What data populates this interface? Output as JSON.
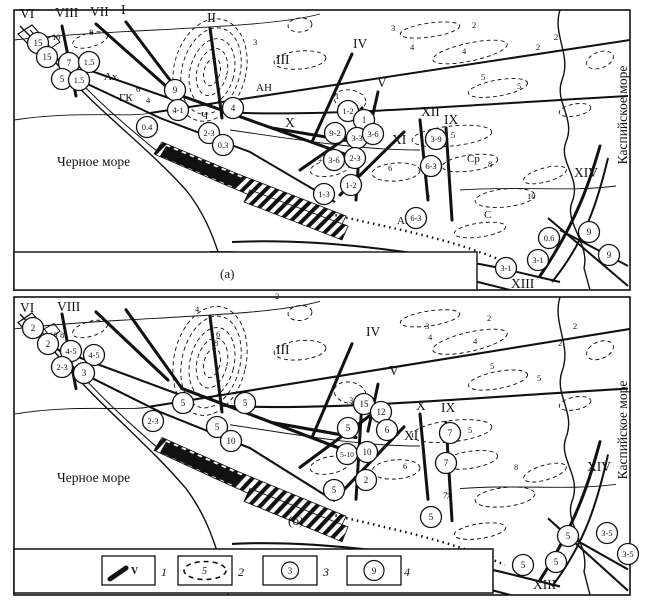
{
  "figure": {
    "panel_a_label": "(а)",
    "panel_b_label": "(б)",
    "black_sea": "Черное море",
    "caspian_sea": "Каспийское море"
  },
  "panel_a": {
    "roman": [
      {
        "t": "VI",
        "x": 20,
        "y": 18
      },
      {
        "t": "VIII",
        "x": 55,
        "y": 17
      },
      {
        "t": "VII",
        "x": 90,
        "y": 16
      },
      {
        "t": "I",
        "x": 121,
        "y": 14
      },
      {
        "t": "II",
        "x": 207,
        "y": 22
      },
      {
        "t": "III",
        "x": 276,
        "y": 64
      },
      {
        "t": "IV",
        "x": 353,
        "y": 48
      },
      {
        "t": "V",
        "x": 377,
        "y": 87
      },
      {
        "t": "X",
        "x": 285,
        "y": 127
      },
      {
        "t": "XI",
        "x": 392,
        "y": 144
      },
      {
        "t": "XII",
        "x": 421,
        "y": 116
      },
      {
        "t": "IX",
        "x": 444,
        "y": 124
      },
      {
        "t": "XIV",
        "x": 574,
        "y": 177
      },
      {
        "t": "XIII",
        "x": 511,
        "y": 288
      }
    ],
    "fault_names": [
      {
        "t": "Ах",
        "x": 104,
        "y": 80
      },
      {
        "t": "ГК",
        "x": 119,
        "y": 101
      },
      {
        "t": "АН",
        "x": 256,
        "y": 91
      },
      {
        "t": "Ч",
        "x": 201,
        "y": 119
      },
      {
        "t": "АН",
        "x": 397,
        "y": 224
      },
      {
        "t": "Ср",
        "x": 467,
        "y": 162
      },
      {
        "t": "С",
        "x": 484,
        "y": 218
      }
    ],
    "contours": [
      {
        "t": "10",
        "x": 52,
        "y": 40
      },
      {
        "t": "8",
        "x": 89,
        "y": 35
      },
      {
        "t": "6",
        "x": 136,
        "y": 92
      },
      {
        "t": "4",
        "x": 146,
        "y": 103
      },
      {
        "t": "3",
        "x": 253,
        "y": 45
      },
      {
        "t": "1",
        "x": 335,
        "y": 99
      },
      {
        "t": "3",
        "x": 391,
        "y": 31
      },
      {
        "t": "4",
        "x": 410,
        "y": 50
      },
      {
        "t": "2",
        "x": 472,
        "y": 28
      },
      {
        "t": "2",
        "x": 536,
        "y": 50
      },
      {
        "t": "2",
        "x": 554,
        "y": 40
      },
      {
        "t": "4",
        "x": 462,
        "y": 54
      },
      {
        "t": "5",
        "x": 481,
        "y": 80
      },
      {
        "t": "5",
        "x": 517,
        "y": 89
      },
      {
        "t": "5",
        "x": 451,
        "y": 138
      },
      {
        "t": "+1",
        "x": 318,
        "y": 163
      },
      {
        "t": "6",
        "x": 388,
        "y": 171
      },
      {
        "t": "7",
        "x": 426,
        "y": 201
      },
      {
        "t": "8",
        "x": 488,
        "y": 167
      },
      {
        "t": "10",
        "x": 527,
        "y": 199
      }
    ],
    "markers": [
      {
        "v": "15",
        "x": 38,
        "y": 43
      },
      {
        "v": "15",
        "x": 47,
        "y": 57
      },
      {
        "v": "7",
        "x": 69,
        "y": 63
      },
      {
        "v": "1.5",
        "x": 89,
        "y": 62
      },
      {
        "v": "5",
        "x": 62,
        "y": 79
      },
      {
        "v": "1.5",
        "x": 79,
        "y": 80
      },
      {
        "v": "9",
        "x": 175,
        "y": 90
      },
      {
        "v": "4-1",
        "x": 178,
        "y": 110
      },
      {
        "v": "0.4",
        "x": 147,
        "y": 127
      },
      {
        "v": "4",
        "x": 233,
        "y": 108
      },
      {
        "v": "2-3",
        "x": 209,
        "y": 133
      },
      {
        "v": "0.3",
        "x": 223,
        "y": 145
      },
      {
        "v": "1-2",
        "x": 348,
        "y": 111
      },
      {
        "v": "1",
        "x": 364,
        "y": 120
      },
      {
        "v": "9-2",
        "x": 335,
        "y": 133
      },
      {
        "v": "3-3",
        "x": 357,
        "y": 138
      },
      {
        "v": "3-6",
        "x": 373,
        "y": 134
      },
      {
        "v": "3-9",
        "x": 436,
        "y": 139
      },
      {
        "v": "3-6",
        "x": 334,
        "y": 160
      },
      {
        "v": "2-3",
        "x": 355,
        "y": 158
      },
      {
        "v": "1-2",
        "x": 351,
        "y": 185
      },
      {
        "v": "1-3",
        "x": 324,
        "y": 194
      },
      {
        "v": "6-3",
        "x": 431,
        "y": 166
      },
      {
        "v": "6-3",
        "x": 416,
        "y": 218
      },
      {
        "v": "0.6",
        "x": 549,
        "y": 238
      },
      {
        "v": "9",
        "x": 589,
        "y": 232
      },
      {
        "v": "9",
        "x": 609,
        "y": 255
      },
      {
        "v": "3-1",
        "x": 538,
        "y": 260
      },
      {
        "v": "3-1",
        "x": 506,
        "y": 268
      }
    ]
  },
  "panel_b": {
    "roman": [
      {
        "t": "VI",
        "x": 20,
        "y": 312
      },
      {
        "t": "VIII",
        "x": 57,
        "y": 311
      },
      {
        "t": "III",
        "x": 276,
        "y": 354
      },
      {
        "t": "IV",
        "x": 366,
        "y": 336
      },
      {
        "t": "V",
        "x": 389,
        "y": 375
      },
      {
        "t": "X",
        "x": 416,
        "y": 410
      },
      {
        "t": "IX",
        "x": 441,
        "y": 412
      },
      {
        "t": "XI",
        "x": 404,
        "y": 440
      },
      {
        "t": "XIV",
        "x": 587,
        "y": 471
      },
      {
        "t": "XIII",
        "x": 533,
        "y": 589
      }
    ],
    "fault_names": [],
    "contours": [
      {
        "t": "10",
        "x": 49,
        "y": 338
      },
      {
        "t": "8",
        "x": 60,
        "y": 338
      },
      {
        "t": "2",
        "x": 275,
        "y": 299
      },
      {
        "t": "4",
        "x": 195,
        "y": 312
      },
      {
        "t": "6",
        "x": 216,
        "y": 337
      },
      {
        "t": "8",
        "x": 214,
        "y": 346
      },
      {
        "t": "3",
        "x": 425,
        "y": 329
      },
      {
        "t": "4",
        "x": 428,
        "y": 340
      },
      {
        "t": "4",
        "x": 473,
        "y": 344
      },
      {
        "t": "2",
        "x": 487,
        "y": 321
      },
      {
        "t": "2",
        "x": 573,
        "y": 329
      },
      {
        "t": "2",
        "x": 558,
        "y": 346
      },
      {
        "t": "5",
        "x": 490,
        "y": 369
      },
      {
        "t": "5",
        "x": 537,
        "y": 381
      },
      {
        "t": "5",
        "x": 468,
        "y": 433
      },
      {
        "t": "3",
        "x": 349,
        "y": 403
      },
      {
        "t": "6",
        "x": 403,
        "y": 469
      },
      {
        "t": "7",
        "x": 443,
        "y": 498
      },
      {
        "t": "8",
        "x": 514,
        "y": 470
      },
      {
        "t": "7",
        "x": 446,
        "y": 499
      }
    ],
    "markers": [
      {
        "v": "2",
        "x": 33,
        "y": 328
      },
      {
        "v": "2",
        "x": 48,
        "y": 344
      },
      {
        "v": "4-5",
        "x": 71,
        "y": 351
      },
      {
        "v": "4-5",
        "x": 94,
        "y": 355
      },
      {
        "v": "2-3",
        "x": 62,
        "y": 367
      },
      {
        "v": "3",
        "x": 84,
        "y": 373
      },
      {
        "v": "5",
        "x": 183,
        "y": 403
      },
      {
        "v": "2-3",
        "x": 153,
        "y": 421
      },
      {
        "v": "5",
        "x": 245,
        "y": 403
      },
      {
        "v": "5",
        "x": 217,
        "y": 427
      },
      {
        "v": "10",
        "x": 231,
        "y": 441
      },
      {
        "v": "15",
        "x": 364,
        "y": 404
      },
      {
        "v": "12",
        "x": 381,
        "y": 412
      },
      {
        "v": "5",
        "x": 348,
        "y": 428
      },
      {
        "v": "6",
        "x": 387,
        "y": 430
      },
      {
        "v": "5-10",
        "x": 347,
        "y": 454
      },
      {
        "v": "10",
        "x": 367,
        "y": 452
      },
      {
        "v": "2",
        "x": 366,
        "y": 480
      },
      {
        "v": "5",
        "x": 334,
        "y": 490
      },
      {
        "v": "7",
        "x": 450,
        "y": 433
      },
      {
        "v": "7",
        "x": 446,
        "y": 463
      },
      {
        "v": "5",
        "x": 431,
        "y": 517
      },
      {
        "v": "5",
        "x": 568,
        "y": 536
      },
      {
        "v": "3-5",
        "x": 607,
        "y": 533
      },
      {
        "v": "3-5",
        "x": 628,
        "y": 554
      },
      {
        "v": "5",
        "x": 556,
        "y": 562
      },
      {
        "v": "5",
        "x": 523,
        "y": 565
      }
    ]
  },
  "legend": {
    "items": [
      {
        "symbol": "fault-line",
        "symbol_label": "V",
        "index": "1"
      },
      {
        "symbol": "dashed-contour",
        "symbol_label": "5",
        "index": "2"
      },
      {
        "symbol": "circle-small",
        "symbol_label": "3",
        "index": "3"
      },
      {
        "symbol": "circle-large",
        "symbol_label": "9",
        "index": "4"
      }
    ]
  }
}
